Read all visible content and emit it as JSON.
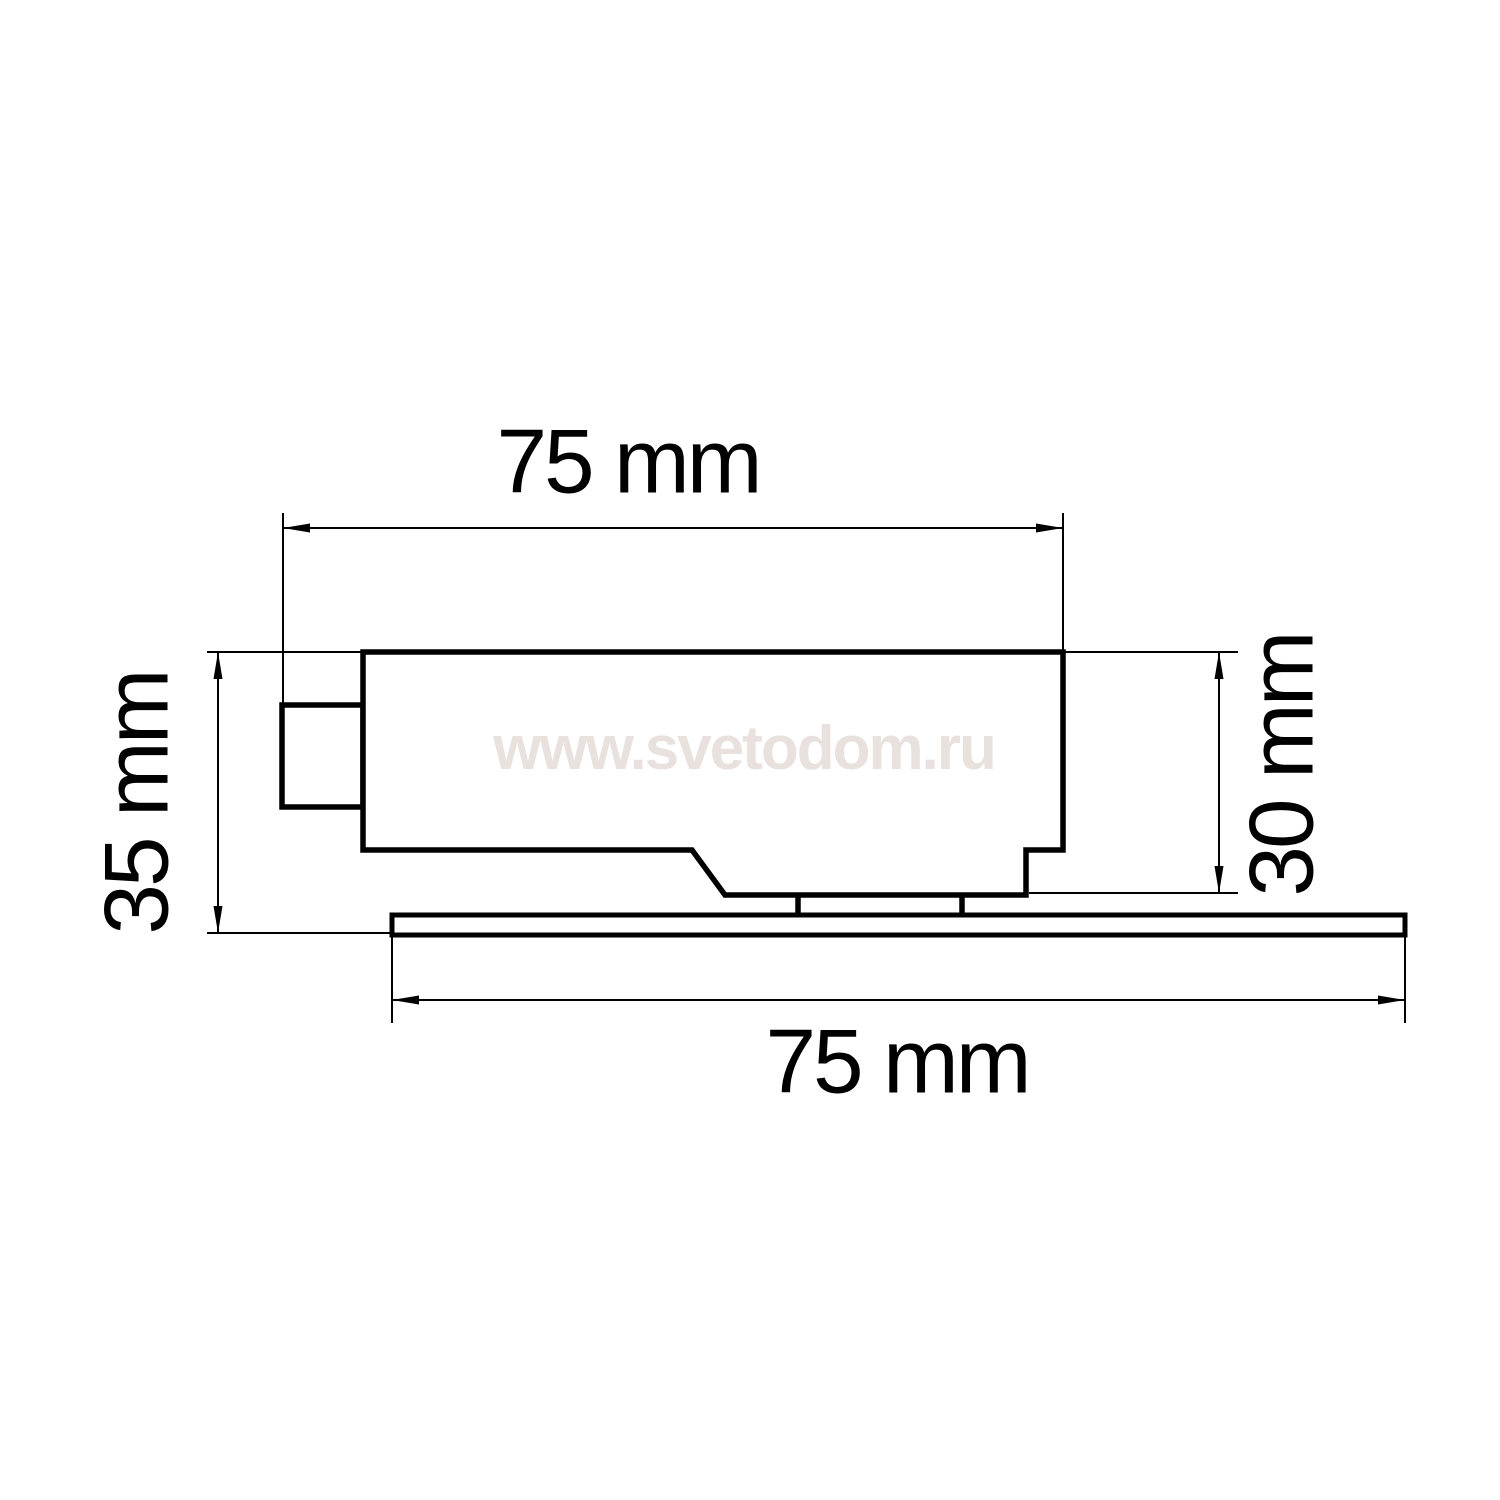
{
  "page": {
    "background_color": "#ffffff",
    "line_color": "#000000"
  },
  "watermark": {
    "text": "www.svetodom.ru",
    "color": "#e8e1dd"
  },
  "dimensions": {
    "top": {
      "label": "75 mm",
      "value": 75,
      "unit": "mm"
    },
    "left": {
      "label": "35 mm",
      "value": 35,
      "unit": "mm"
    },
    "right": {
      "label": "30 mm",
      "value": 30,
      "unit": "mm"
    },
    "bottom": {
      "label": "75 mm",
      "value": 75,
      "unit": "mm"
    }
  }
}
